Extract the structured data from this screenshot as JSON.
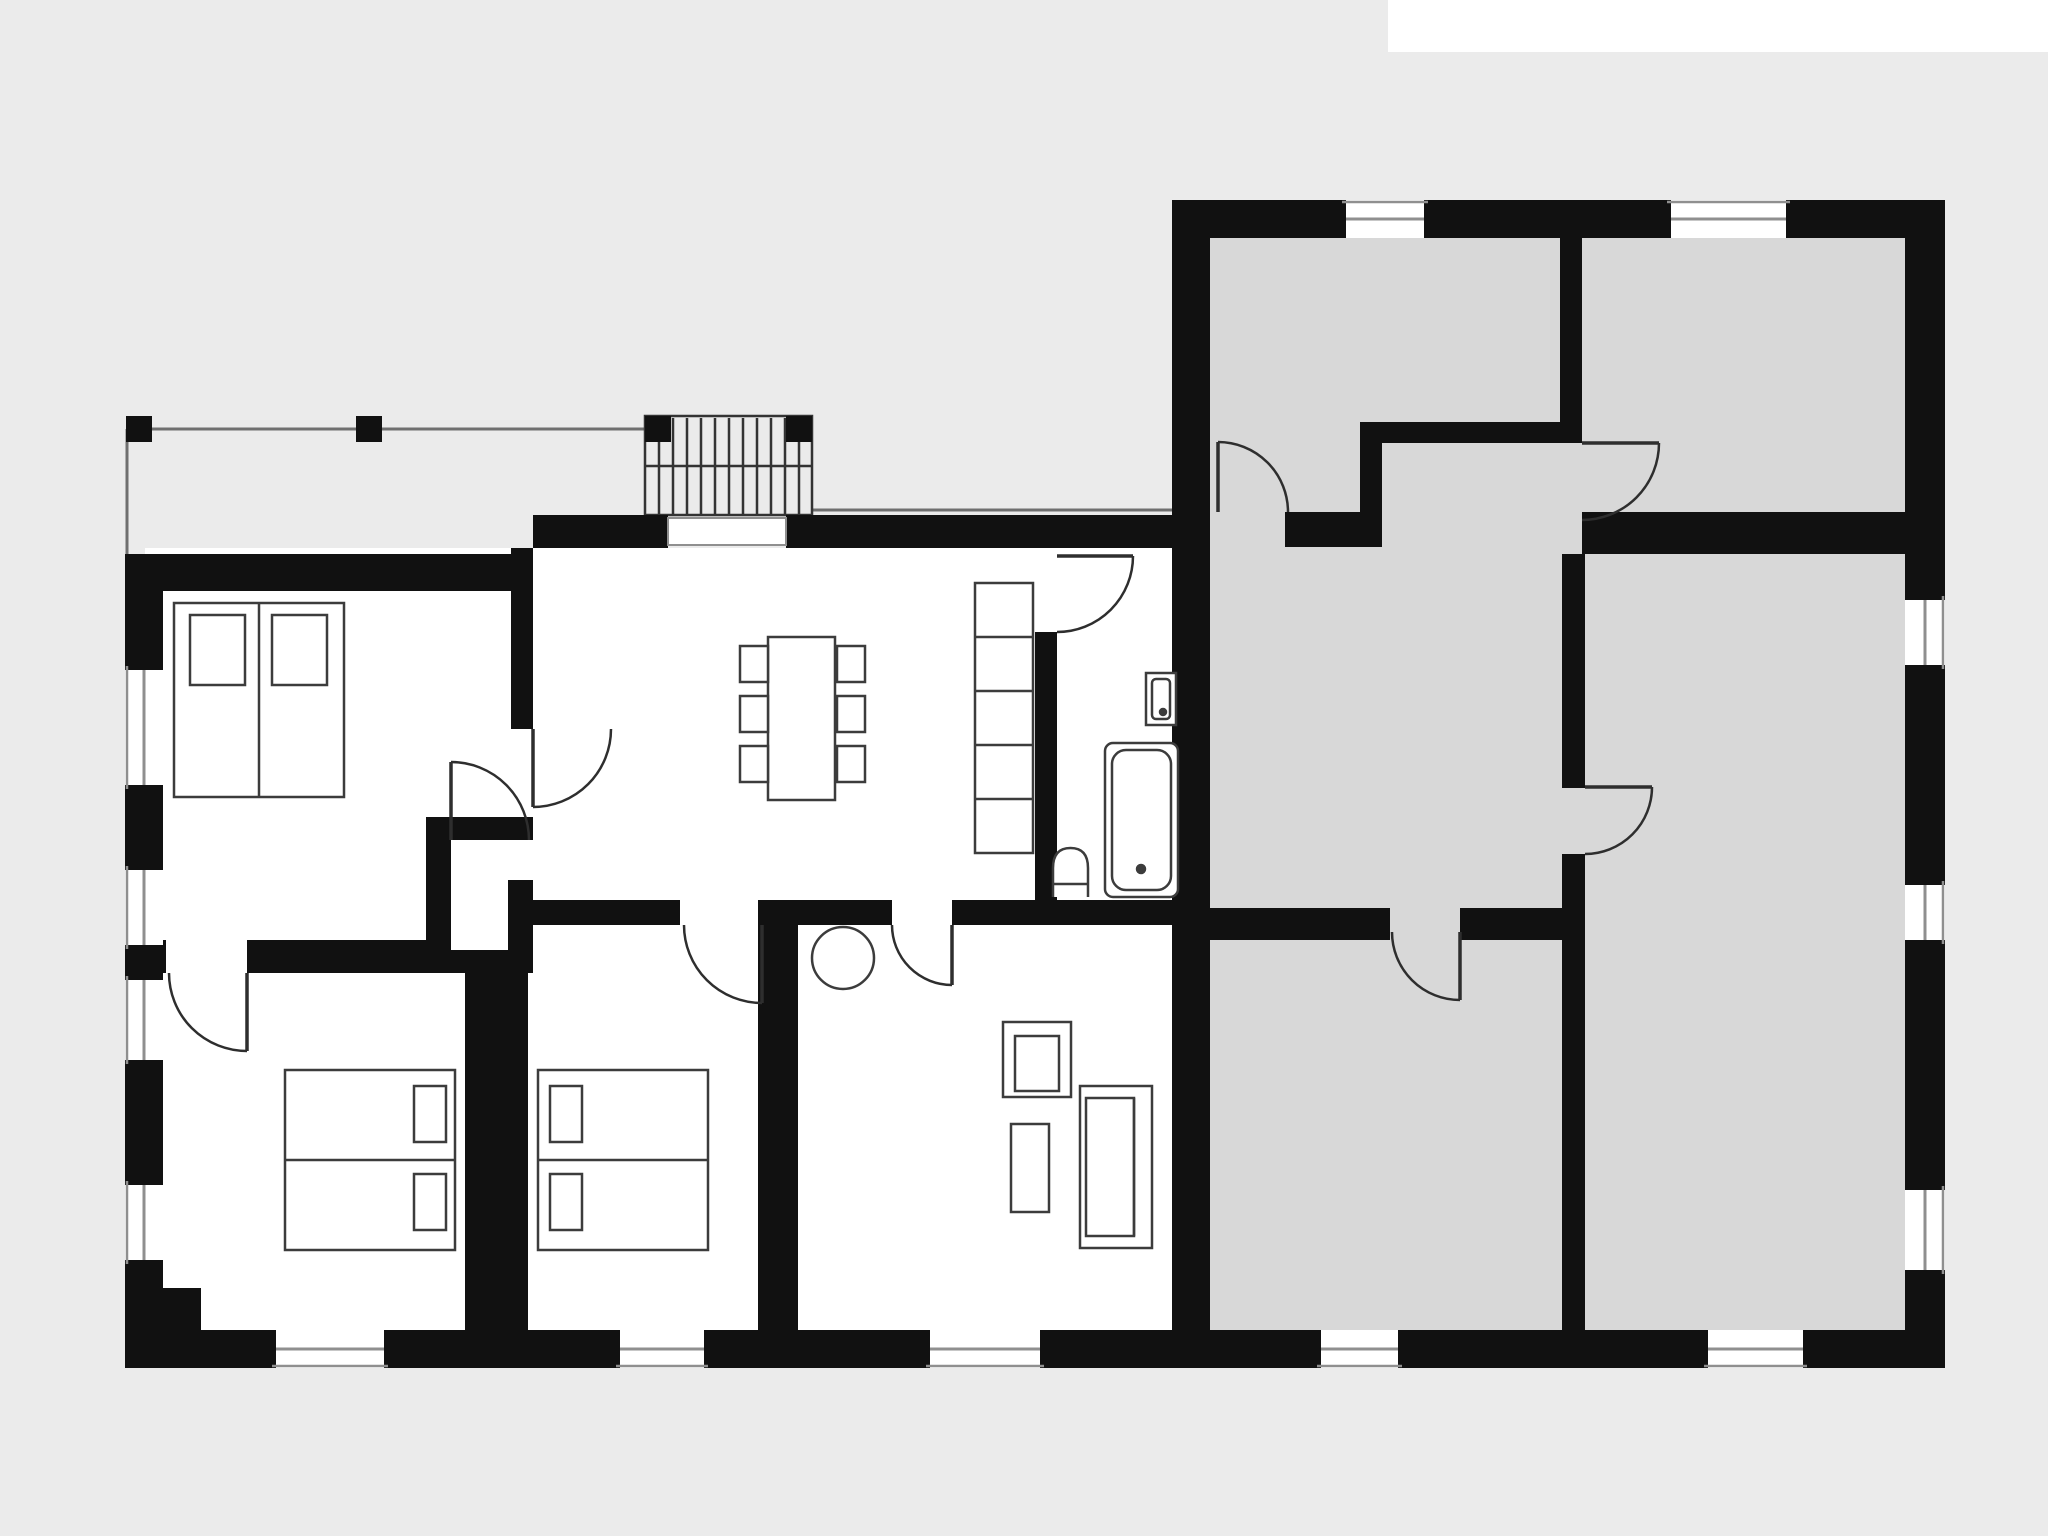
{
  "plan": {
    "canvas": {
      "w": 2048,
      "h": 1536
    },
    "colors": {
      "bg": "#ebebeb",
      "patch": "#ffffff",
      "wall": "#111111",
      "floorWhite": "#ffffff",
      "floorGray": "#d8d8d8",
      "furn": "#3c3c3c",
      "thin": "#8f8f8f",
      "door": "#2e2e2e",
      "stair": "#333333",
      "terrace": "#6f6f6f"
    },
    "white_patch": {
      "name": "top-right-white-strip",
      "x": 1388,
      "y": 0,
      "w": 660,
      "h": 52
    },
    "floors": [
      {
        "name": "floor-left-unit",
        "fill": "floorWhite",
        "x": 145,
        "y": 548,
        "w": 1027,
        "h": 782
      },
      {
        "name": "floor-right-unit",
        "fill": "floorGray",
        "x": 1210,
        "y": 238,
        "w": 695,
        "h": 1092
      }
    ],
    "terrace": {
      "lines": [
        {
          "name": "terrace-edge-line",
          "x1": 126,
          "y1": 429,
          "x2": 648,
          "y2": 429
        },
        {
          "name": "terrace-side-line",
          "x1": 127,
          "y1": 429,
          "x2": 127,
          "y2": 554
        },
        {
          "name": "eave-line",
          "x1": 812,
          "y1": 510,
          "x2": 1172,
          "y2": 510
        }
      ],
      "posts": [
        {
          "name": "terrace-post",
          "x": 126,
          "y": 416,
          "w": 26,
          "h": 26
        },
        {
          "name": "terrace-post",
          "x": 356,
          "y": 416,
          "w": 26,
          "h": 26
        },
        {
          "name": "stair-post",
          "x": 645,
          "y": 416,
          "w": 26,
          "h": 26
        },
        {
          "name": "stair-post",
          "x": 786,
          "y": 416,
          "w": 26,
          "h": 26
        }
      ]
    },
    "stairs": {
      "name": "exterior-stairs",
      "outline": {
        "x": 645,
        "y": 416,
        "w": 167,
        "h": 99
      },
      "tread_xs": [
        659,
        673,
        687,
        701,
        715,
        729,
        743,
        757,
        771,
        785,
        799
      ],
      "tread_y1": 418,
      "tread_y2": 515,
      "rail": {
        "x1": 645,
        "y1": 466,
        "x2": 812,
        "y2": 466
      }
    },
    "walls": [
      {
        "name": "wall-top-left-unit",
        "x": 533,
        "y": 515,
        "w": 135,
        "h": 33
      },
      {
        "name": "wall-top-left-unit",
        "x": 786,
        "y": 515,
        "w": 424,
        "h": 33
      },
      {
        "name": "wall-bedroom1-top",
        "x": 125,
        "y": 554,
        "w": 408,
        "h": 37
      },
      {
        "name": "wall-left-outer",
        "x": 125,
        "y": 591,
        "w": 38,
        "h": 79
      },
      {
        "name": "wall-left-outer",
        "x": 125,
        "y": 785,
        "w": 38,
        "h": 85
      },
      {
        "name": "wall-left-outer",
        "x": 125,
        "y": 945,
        "w": 38,
        "h": 35
      },
      {
        "name": "wall-left-outer",
        "x": 125,
        "y": 1060,
        "w": 38,
        "h": 125
      },
      {
        "name": "wall-left-outer",
        "x": 125,
        "y": 1260,
        "w": 38,
        "h": 108
      },
      {
        "name": "wall-corner-block",
        "x": 125,
        "y": 1288,
        "w": 76,
        "h": 80
      },
      {
        "name": "wall-bottom-outer",
        "x": 125,
        "y": 1330,
        "w": 151,
        "h": 38
      },
      {
        "name": "wall-bottom-outer",
        "x": 384,
        "y": 1330,
        "w": 236,
        "h": 38
      },
      {
        "name": "wall-bottom-outer",
        "x": 704,
        "y": 1330,
        "w": 226,
        "h": 38
      },
      {
        "name": "wall-bottom-outer",
        "x": 1040,
        "y": 1330,
        "w": 281,
        "h": 38
      },
      {
        "name": "wall-bottom-outer",
        "x": 1398,
        "y": 1330,
        "w": 310,
        "h": 38
      },
      {
        "name": "wall-bottom-outer",
        "x": 1803,
        "y": 1330,
        "w": 142,
        "h": 38
      },
      {
        "name": "wall-right-outer",
        "x": 1905,
        "y": 200,
        "w": 40,
        "h": 400
      },
      {
        "name": "wall-right-outer",
        "x": 1905,
        "y": 665,
        "w": 40,
        "h": 220
      },
      {
        "name": "wall-right-outer",
        "x": 1905,
        "y": 940,
        "w": 40,
        "h": 250
      },
      {
        "name": "wall-right-outer",
        "x": 1905,
        "y": 1270,
        "w": 40,
        "h": 98
      },
      {
        "name": "wall-top-right-unit",
        "x": 1172,
        "y": 200,
        "w": 174,
        "h": 38
      },
      {
        "name": "wall-top-right-unit",
        "x": 1424,
        "y": 200,
        "w": 247,
        "h": 38
      },
      {
        "name": "wall-top-right-unit",
        "x": 1786,
        "y": 200,
        "w": 119,
        "h": 38
      },
      {
        "name": "wall-units-divider",
        "x": 1172,
        "y": 238,
        "w": 38,
        "h": 1092
      },
      {
        "name": "wall-bedroom1-east",
        "x": 511,
        "y": 548,
        "w": 22,
        "h": 181
      },
      {
        "name": "wall-closet-top",
        "x": 426,
        "y": 817,
        "w": 107,
        "h": 23
      },
      {
        "name": "wall-closet-left",
        "x": 426,
        "y": 840,
        "w": 25,
        "h": 133
      },
      {
        "name": "wall-closet-right",
        "x": 508,
        "y": 880,
        "w": 25,
        "h": 93
      },
      {
        "name": "wall-closet-bottom",
        "x": 426,
        "y": 950,
        "w": 85,
        "h": 23
      },
      {
        "name": "wall-bedroom2-top",
        "x": 150,
        "y": 940,
        "w": 16,
        "h": 33
      },
      {
        "name": "wall-bedroom2-top",
        "x": 247,
        "y": 940,
        "w": 179,
        "h": 33
      },
      {
        "name": "wall-bedroom2-bedroom3",
        "x": 465,
        "y": 950,
        "w": 63,
        "h": 380
      },
      {
        "name": "wall-hall-bottom",
        "x": 528,
        "y": 900,
        "w": 152,
        "h": 25
      },
      {
        "name": "wall-hall-bottom",
        "x": 798,
        "y": 900,
        "w": 94,
        "h": 25
      },
      {
        "name": "wall-bath-bottom",
        "x": 952,
        "y": 900,
        "w": 220,
        "h": 25
      },
      {
        "name": "wall-bedroom3-living",
        "x": 758,
        "y": 900,
        "w": 40,
        "h": 430
      },
      {
        "name": "wall-bathroom-left",
        "x": 1035,
        "y": 632,
        "w": 22,
        "h": 268
      },
      {
        "name": "wall-grayroom1-grayroom2",
        "x": 1560,
        "y": 238,
        "w": 22,
        "h": 205
      },
      {
        "name": "wall-grayroom1-bottom",
        "x": 1382,
        "y": 422,
        "w": 178,
        "h": 21
      },
      {
        "name": "wall-grayroom1-stub",
        "x": 1360,
        "y": 422,
        "w": 22,
        "h": 125
      },
      {
        "name": "wall-grayroom1-bottom",
        "x": 1285,
        "y": 512,
        "w": 97,
        "h": 35
      },
      {
        "name": "wall-grayroom2-bottom",
        "x": 1582,
        "y": 512,
        "w": 323,
        "h": 42
      },
      {
        "name": "wall-grayhall-east",
        "x": 1562,
        "y": 554,
        "w": 23,
        "h": 234
      },
      {
        "name": "wall-grayhall-east",
        "x": 1562,
        "y": 854,
        "w": 23,
        "h": 476
      },
      {
        "name": "wall-grayhall-bottom",
        "x": 1210,
        "y": 908,
        "w": 180,
        "h": 32
      },
      {
        "name": "wall-grayhall-bottom",
        "x": 1460,
        "y": 908,
        "w": 102,
        "h": 32
      }
    ],
    "windows": [
      {
        "name": "window-left",
        "x": 125,
        "y": 670,
        "w": 38,
        "h": 115,
        "o": "v",
        "e": "left"
      },
      {
        "name": "window-left",
        "x": 125,
        "y": 870,
        "w": 38,
        "h": 75,
        "o": "v",
        "e": "left"
      },
      {
        "name": "window-left",
        "x": 125,
        "y": 980,
        "w": 38,
        "h": 80,
        "o": "v",
        "e": "left"
      },
      {
        "name": "window-left",
        "x": 125,
        "y": 1185,
        "w": 38,
        "h": 75,
        "o": "v",
        "e": "left"
      },
      {
        "name": "window-bottom",
        "x": 276,
        "y": 1330,
        "w": 108,
        "h": 38,
        "o": "h",
        "e": "bottom"
      },
      {
        "name": "window-bottom",
        "x": 620,
        "y": 1330,
        "w": 84,
        "h": 38,
        "o": "h",
        "e": "bottom"
      },
      {
        "name": "window-bottom",
        "x": 930,
        "y": 1330,
        "w": 110,
        "h": 38,
        "o": "h",
        "e": "bottom"
      },
      {
        "name": "window-bottom",
        "x": 1321,
        "y": 1330,
        "w": 77,
        "h": 38,
        "o": "h",
        "e": "bottom"
      },
      {
        "name": "window-bottom",
        "x": 1708,
        "y": 1330,
        "w": 95,
        "h": 38,
        "o": "h",
        "e": "bottom"
      },
      {
        "name": "window-right",
        "x": 1905,
        "y": 600,
        "w": 40,
        "h": 65,
        "o": "v",
        "e": "right"
      },
      {
        "name": "window-right",
        "x": 1905,
        "y": 885,
        "w": 40,
        "h": 55,
        "o": "v",
        "e": "right"
      },
      {
        "name": "window-right",
        "x": 1905,
        "y": 1190,
        "w": 40,
        "h": 80,
        "o": "v",
        "e": "right"
      },
      {
        "name": "window-top",
        "x": 1346,
        "y": 200,
        "w": 78,
        "h": 38,
        "o": "h",
        "e": "top"
      },
      {
        "name": "window-top",
        "x": 1671,
        "y": 200,
        "w": 115,
        "h": 38,
        "o": "h",
        "e": "top"
      }
    ],
    "entry_door_panel": {
      "name": "entry-door-panel",
      "x": 668,
      "y": 518,
      "w": 118,
      "h": 27
    },
    "doors": [
      {
        "name": "door-bedroom1",
        "leaf": [
          533,
          729,
          533,
          807
        ],
        "arc": "M533,807 A78,78 0 0 0 611,729"
      },
      {
        "name": "door-closet",
        "leaf": [
          451,
          840,
          451,
          762
        ],
        "arc": "M451,762 A78,78 0 0 1 529,840"
      },
      {
        "name": "door-bedroom2",
        "leaf": [
          247,
          973,
          247,
          1051
        ],
        "arc": "M247,1051 A78,78 0 0 1 169,973"
      },
      {
        "name": "door-bedroom3",
        "leaf": [
          762,
          925,
          762,
          1003
        ],
        "arc": "M762,1003 A78,78 0 0 1 684,925"
      },
      {
        "name": "door-living-room",
        "leaf": [
          952,
          925,
          952,
          985
        ],
        "arc": "M952,985 A60,60 0 0 1 892,925"
      },
      {
        "name": "door-bathroom",
        "leaf": [
          1057,
          556,
          1133,
          556
        ],
        "arc": "M1133,556 A76,76 0 0 1 1057,632"
      },
      {
        "name": "door-gray-room2",
        "leaf": [
          1582,
          443,
          1659,
          443
        ],
        "arc": "M1659,443 A77,77 0 0 1 1582,520"
      },
      {
        "name": "door-gray-room1",
        "leaf": [
          1218,
          512,
          1218,
          442
        ],
        "arc": "M1218,442 A70,70 0 0 1 1288,512"
      },
      {
        "name": "door-gray-room4",
        "leaf": [
          1585,
          787,
          1652,
          787
        ],
        "arc": "M1652,787 A67,67 0 0 1 1585,854"
      },
      {
        "name": "door-gray-room5",
        "leaf": [
          1460,
          932,
          1460,
          1000
        ],
        "arc": "M1392,932 A68,68 0 0 0 1460,1000"
      }
    ],
    "furniture": [
      {
        "name": "twin-beds-bedroom1",
        "shapes": [
          {
            "t": "rect",
            "x": 174,
            "y": 603,
            "w": 170,
            "h": 194
          },
          {
            "t": "line",
            "x1": 259,
            "y1": 603,
            "x2": 259,
            "y2": 797
          },
          {
            "t": "rect",
            "x": 190,
            "y": 615,
            "w": 55,
            "h": 70
          },
          {
            "t": "rect",
            "x": 272,
            "y": 615,
            "w": 55,
            "h": 70
          }
        ]
      },
      {
        "name": "double-bed-bedroom2",
        "shapes": [
          {
            "t": "rect",
            "x": 285,
            "y": 1070,
            "w": 170,
            "h": 180
          },
          {
            "t": "line",
            "x1": 285,
            "y1": 1160,
            "x2": 455,
            "y2": 1160
          },
          {
            "t": "rect",
            "x": 414,
            "y": 1086,
            "w": 32,
            "h": 56
          },
          {
            "t": "rect",
            "x": 414,
            "y": 1174,
            "w": 32,
            "h": 56
          }
        ]
      },
      {
        "name": "double-bed-bedroom3",
        "shapes": [
          {
            "t": "rect",
            "x": 538,
            "y": 1070,
            "w": 170,
            "h": 180
          },
          {
            "t": "line",
            "x1": 538,
            "y1": 1160,
            "x2": 708,
            "y2": 1160
          },
          {
            "t": "rect",
            "x": 550,
            "y": 1086,
            "w": 32,
            "h": 56
          },
          {
            "t": "rect",
            "x": 550,
            "y": 1174,
            "w": 32,
            "h": 56
          }
        ]
      },
      {
        "name": "dining-table",
        "shapes": [
          {
            "t": "rect",
            "x": 768,
            "y": 637,
            "w": 67,
            "h": 163
          },
          {
            "t": "rect",
            "x": 740,
            "y": 646,
            "w": 28,
            "h": 36
          },
          {
            "t": "rect",
            "x": 740,
            "y": 696,
            "w": 28,
            "h": 36
          },
          {
            "t": "rect",
            "x": 740,
            "y": 746,
            "w": 28,
            "h": 36
          },
          {
            "t": "rect",
            "x": 837,
            "y": 646,
            "w": 28,
            "h": 36
          },
          {
            "t": "rect",
            "x": 837,
            "y": 696,
            "w": 28,
            "h": 36
          },
          {
            "t": "rect",
            "x": 837,
            "y": 746,
            "w": 28,
            "h": 36
          }
        ]
      },
      {
        "name": "shelf-unit",
        "shapes": [
          {
            "t": "rect",
            "x": 975,
            "y": 583,
            "w": 58,
            "h": 270
          },
          {
            "t": "line",
            "x1": 975,
            "y1": 637,
            "x2": 1033,
            "y2": 637
          },
          {
            "t": "line",
            "x1": 975,
            "y1": 691,
            "x2": 1033,
            "y2": 691
          },
          {
            "t": "line",
            "x1": 975,
            "y1": 745,
            "x2": 1033,
            "y2": 745
          },
          {
            "t": "line",
            "x1": 975,
            "y1": 799,
            "x2": 1033,
            "y2": 799
          }
        ]
      },
      {
        "name": "bathroom-sink",
        "shapes": [
          {
            "t": "rect",
            "x": 1146,
            "y": 673,
            "w": 30,
            "h": 52
          },
          {
            "t": "rect",
            "x": 1152,
            "y": 679,
            "w": 18,
            "h": 40,
            "rx": 4
          },
          {
            "t": "circle",
            "cx": 1163,
            "cy": 712,
            "r": 3
          }
        ]
      },
      {
        "name": "bathtub",
        "shapes": [
          {
            "t": "rect",
            "x": 1105,
            "y": 743,
            "w": 73,
            "h": 154,
            "rx": 8
          },
          {
            "t": "rect",
            "x": 1112,
            "y": 750,
            "w": 59,
            "h": 140,
            "rx": 14
          },
          {
            "t": "circle",
            "cx": 1141,
            "cy": 869,
            "r": 4
          }
        ]
      },
      {
        "name": "toilet",
        "shapes": [
          {
            "t": "path",
            "d": "M1053,897 L1053,868 Q1053,848 1070.5,848 Q1088,848 1088,868 L1088,897"
          },
          {
            "t": "line",
            "x1": 1053,
            "y1": 884,
            "x2": 1088,
            "y2": 884
          }
        ]
      },
      {
        "name": "round-side-table",
        "shapes": [
          {
            "t": "circle",
            "cx": 843,
            "cy": 958,
            "r": 31
          }
        ]
      },
      {
        "name": "armchair",
        "shapes": [
          {
            "t": "rect",
            "x": 1003,
            "y": 1022,
            "w": 68,
            "h": 75
          },
          {
            "t": "rect",
            "x": 1015,
            "y": 1036,
            "w": 44,
            "h": 55
          }
        ]
      },
      {
        "name": "coffee-table",
        "shapes": [
          {
            "t": "rect",
            "x": 1011,
            "y": 1124,
            "w": 38,
            "h": 88
          }
        ]
      },
      {
        "name": "sofa",
        "shapes": [
          {
            "t": "rect",
            "x": 1080,
            "y": 1086,
            "w": 72,
            "h": 162
          },
          {
            "t": "rect",
            "x": 1086,
            "y": 1098,
            "w": 48,
            "h": 138
          },
          {
            "t": "line",
            "x1": 1134,
            "y1": 1098,
            "x2": 1134,
            "y2": 1236
          }
        ]
      }
    ]
  }
}
